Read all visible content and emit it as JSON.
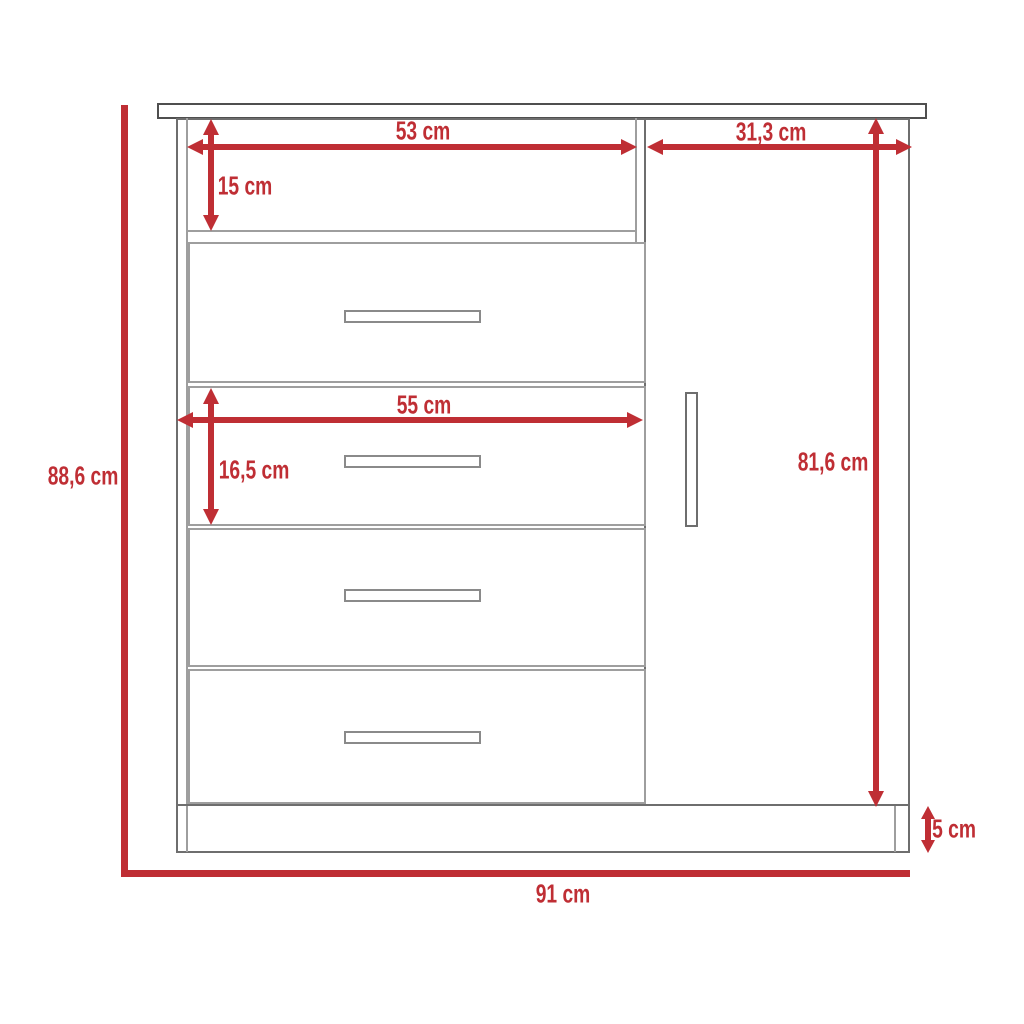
{
  "diagram": {
    "description": "Dresser technical drawing with dimensions",
    "accent_color": "#bf2e34",
    "outline_color": "#6e6e6e",
    "labels": {
      "overall_height": "88,6 cm",
      "overall_width": "91 cm",
      "shelf_width": "53 cm",
      "shelf_height": "15 cm",
      "door_width": "31,3 cm",
      "door_height": "81,6 cm",
      "drawer_width": "55 cm",
      "drawer_height": "16,5 cm",
      "base_height": "5 cm"
    }
  }
}
